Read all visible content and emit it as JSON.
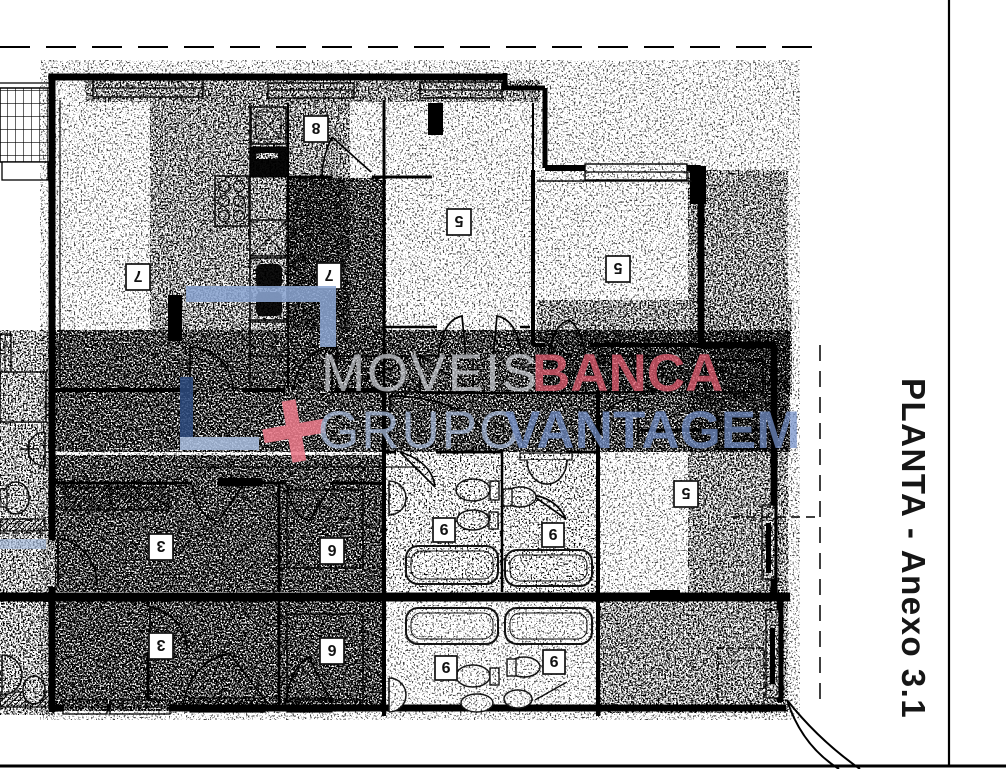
{
  "title_block": {
    "side_label": "PLANTA - Anexo 3.1"
  },
  "watermark": {
    "brand_word_1": "MOVEIS",
    "brand_word_2": "BANCA",
    "brand_word_3": "GRUPO",
    "brand_word_4": "VANTAGEM",
    "plus_sign": "+",
    "colors": {
      "gray_light": "#c9ccd2",
      "red_bold": "#eb6176",
      "blue_light": "#abbedd",
      "blue_bold": "#7691c9",
      "logo_blue": "#8ba6d2",
      "logo_navy": "#2d4b7e",
      "logo_pale": "#a9bedf",
      "plus_red": "#ec7b8b"
    }
  },
  "room_labels": [
    "7",
    "8",
    "7",
    "5",
    "5",
    "5",
    "3",
    "6",
    "3",
    "6",
    "9",
    "9",
    "9",
    "9"
  ],
  "drawing": {
    "ink": "#000000",
    "paper": "#ffffff"
  }
}
